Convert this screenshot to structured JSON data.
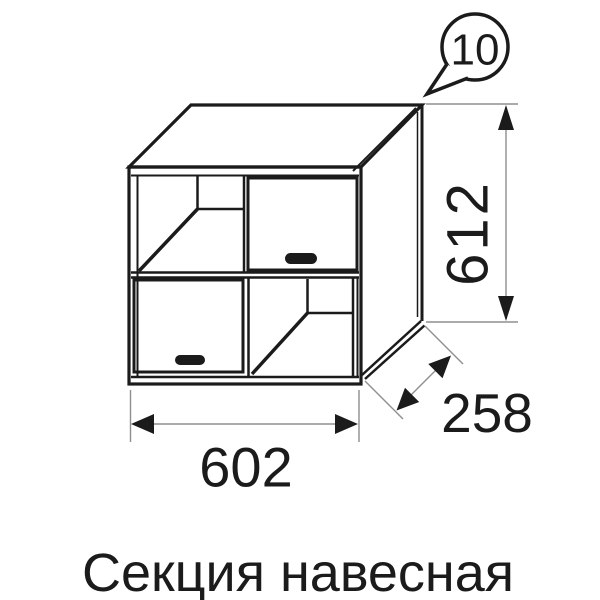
{
  "drawing": {
    "subject": "wall-mounted cabinet section, two doors and two open shelf compartments",
    "caption": "Секция навесная"
  },
  "callout": {
    "number": "10"
  },
  "dimensions": {
    "width": "602",
    "height": "612",
    "depth": "258"
  },
  "colors": {
    "line": "#1b1b1b",
    "dimension_line": "#8f8f8f",
    "background": "#ffffff"
  }
}
